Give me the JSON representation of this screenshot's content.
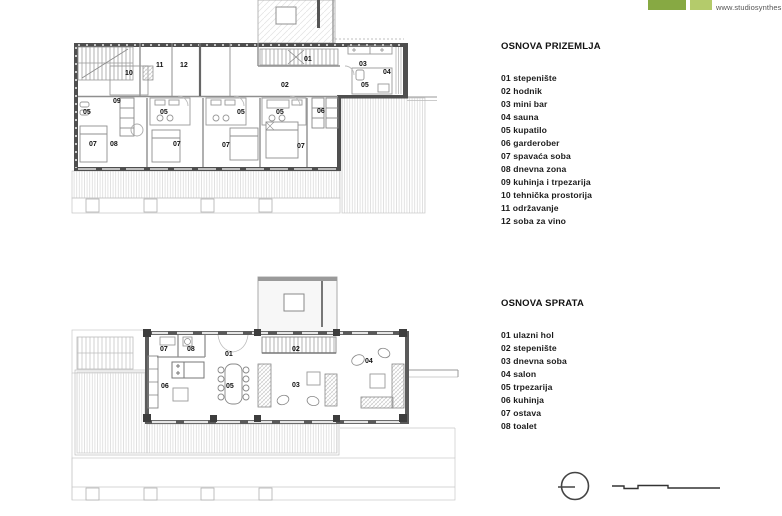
{
  "branding": {
    "url": "www.studiosynthesis.me",
    "logo_colors": {
      "dark_green": "#87a943",
      "light_green": "#b4cb6b"
    },
    "logo_blocks": [
      "dark-green-block",
      "light-green-block"
    ]
  },
  "legend_ground": {
    "title": "OSNOVA PRIZEMLJA",
    "items": [
      "01 stepenište",
      "02 hodnik",
      "03 mini bar",
      "04 sauna",
      "05 kupatilo",
      "06 garderober",
      "07 spavaća soba",
      "08 dnevna zona",
      "09 kuhinja i trpezarija",
      "10 tehnička prostorija",
      "11 održavanje",
      "12 soba za vino"
    ]
  },
  "legend_upper": {
    "title": "OSNOVA SPRATA",
    "items": [
      "01 ulazni hol",
      "02 stepenište",
      "03 dnevna soba",
      "04 salon",
      "05 trpezarija",
      "06 kuhinja",
      "07 ostava",
      "08 toalet"
    ]
  },
  "plans": {
    "ground": {
      "labels": [
        {
          "t": "10",
          "x": 125,
          "y": 75
        },
        {
          "t": "11",
          "x": 156,
          "y": 67
        },
        {
          "t": "12",
          "x": 180,
          "y": 67
        },
        {
          "t": "01",
          "x": 304,
          "y": 61
        },
        {
          "t": "02",
          "x": 281,
          "y": 87
        },
        {
          "t": "03",
          "x": 359,
          "y": 66
        },
        {
          "t": "04",
          "x": 383,
          "y": 74
        },
        {
          "t": "05",
          "x": 361,
          "y": 87
        },
        {
          "t": "09",
          "x": 113,
          "y": 103
        },
        {
          "t": "05",
          "x": 83,
          "y": 114
        },
        {
          "t": "05",
          "x": 160,
          "y": 114
        },
        {
          "t": "05",
          "x": 237,
          "y": 114
        },
        {
          "t": "05",
          "x": 276,
          "y": 114
        },
        {
          "t": "06",
          "x": 317,
          "y": 113
        },
        {
          "t": "07",
          "x": 89,
          "y": 146
        },
        {
          "t": "08",
          "x": 110,
          "y": 146
        },
        {
          "t": "07",
          "x": 173,
          "y": 146
        },
        {
          "t": "07",
          "x": 222,
          "y": 147
        },
        {
          "t": "07",
          "x": 297,
          "y": 148
        }
      ]
    },
    "upper": {
      "labels": [
        {
          "t": "07",
          "x": 160,
          "y": 351
        },
        {
          "t": "08",
          "x": 187,
          "y": 351
        },
        {
          "t": "01",
          "x": 225,
          "y": 356
        },
        {
          "t": "02",
          "x": 292,
          "y": 351
        },
        {
          "t": "04",
          "x": 365,
          "y": 363
        },
        {
          "t": "06",
          "x": 161,
          "y": 388
        },
        {
          "t": "05",
          "x": 226,
          "y": 388
        },
        {
          "t": "03",
          "x": 292,
          "y": 387
        }
      ]
    }
  },
  "symbols": {
    "north_icon": "north-indicator-circle",
    "scale_icon": "graphic-scale-bar"
  }
}
